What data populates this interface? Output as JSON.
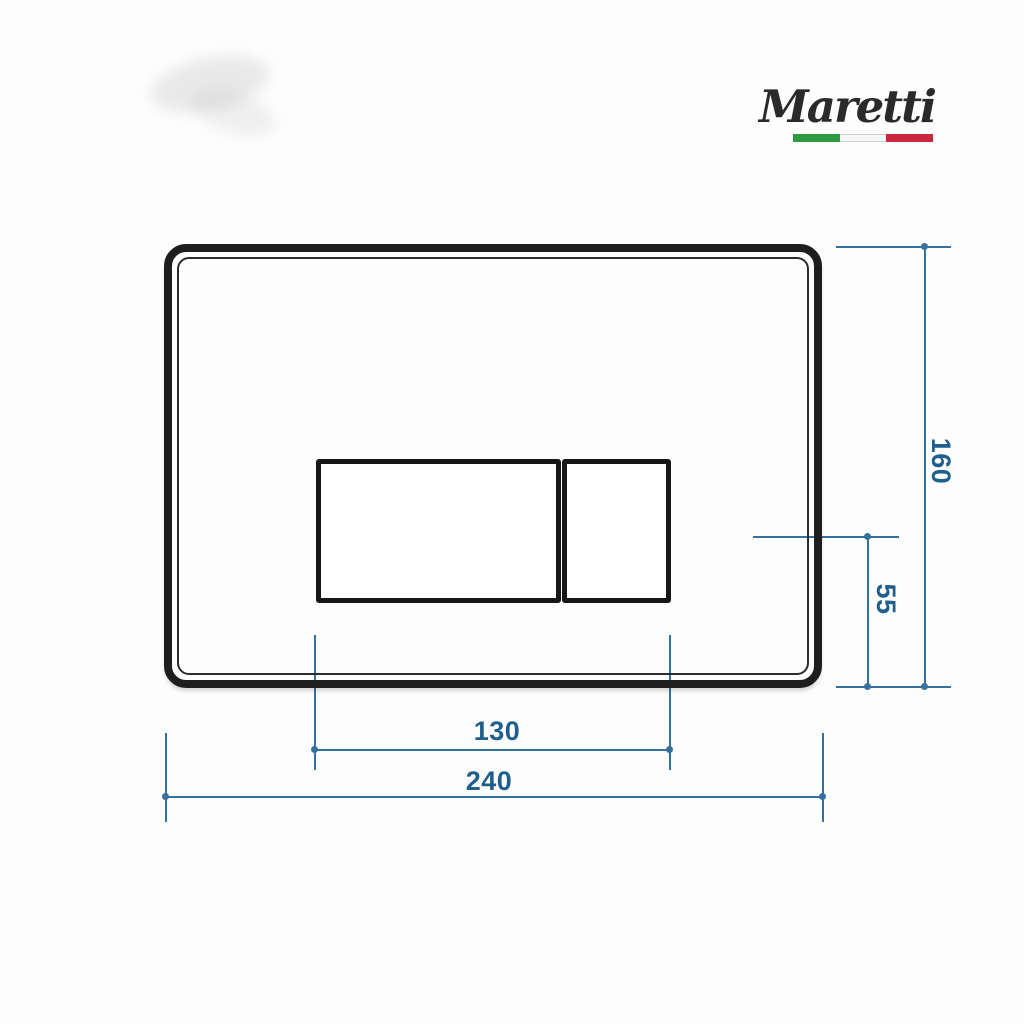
{
  "brand": {
    "name": "Maretti",
    "flag_colors": {
      "green": "#2e9a43",
      "white": "#f6f6f6",
      "red": "#c8293e"
    }
  },
  "drawing": {
    "subject": "flush-plate-front-view-technical-drawing",
    "dimensions": [
      {
        "id": "plate-height",
        "value": "160",
        "orientation": "vertical"
      },
      {
        "id": "button-offset",
        "value": "55",
        "orientation": "vertical"
      },
      {
        "id": "button-width",
        "value": "130",
        "orientation": "horizontal"
      },
      {
        "id": "plate-width",
        "value": "240",
        "orientation": "horizontal"
      }
    ]
  },
  "colors": {
    "background": "#fdfdfd",
    "plate_outline": "#1e1e1e",
    "dimension_line": "#35719c",
    "dimension_text": "#1e5f8d",
    "logo_text": "#2a2a2a"
  }
}
